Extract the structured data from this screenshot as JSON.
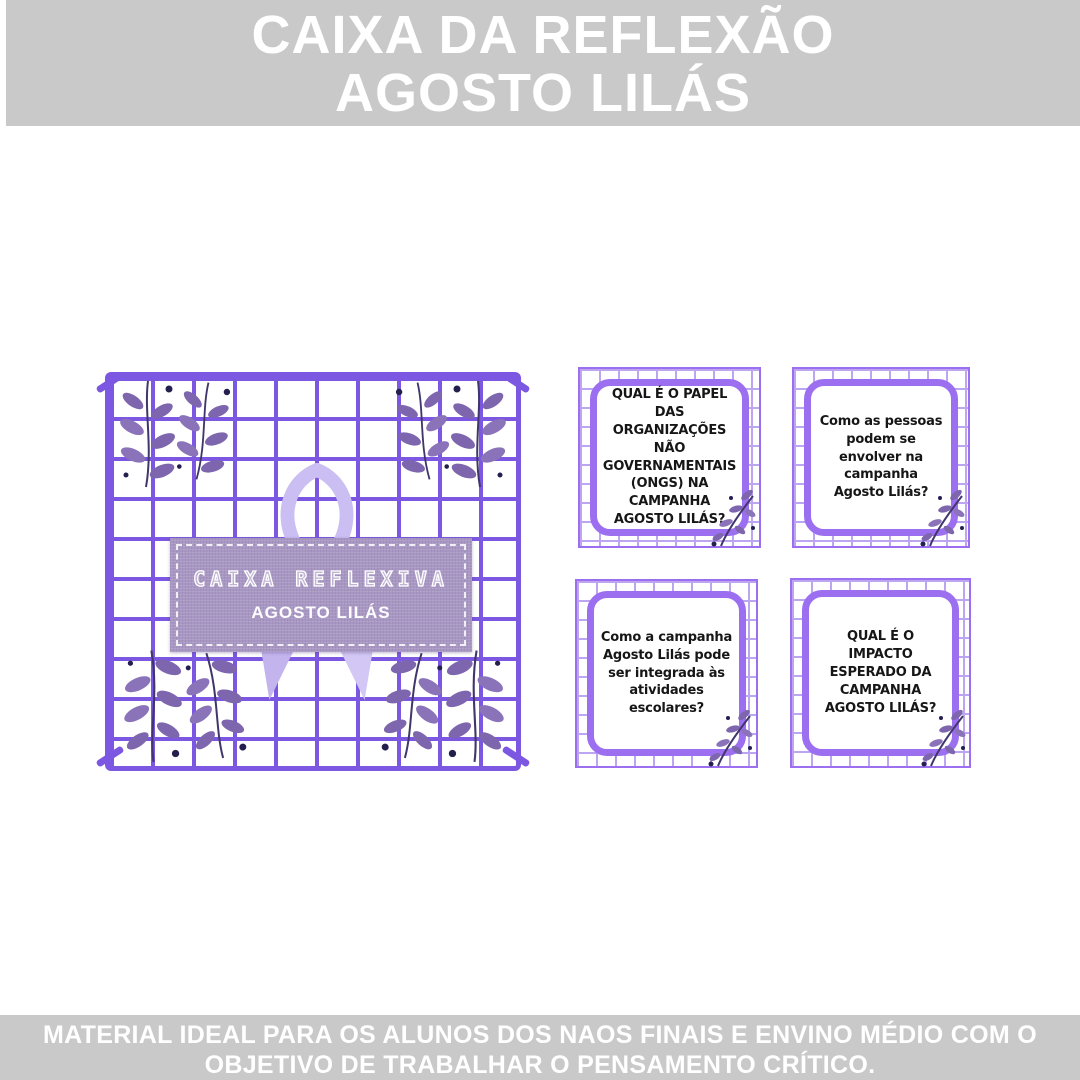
{
  "colors": {
    "banner_bg": "#c9c9c9",
    "banner_text": "#ffffff",
    "grid": "#7c58e2",
    "card_border": "#9c6ff0",
    "card_grid": "#bda6f1",
    "label_bg": "#a897c3",
    "ribbon": "#cbbef2",
    "ribbon_shade": "#c3b4ee",
    "ribbon_light": "#d2c7f5",
    "leaf": "#7d66ad",
    "leaf_light": "#8a73b8",
    "leaf_stem": "#40366b",
    "berry": "#232050"
  },
  "header": {
    "line1": "CAIXA DA REFLEXÃO",
    "line2": "AGOSTO LILÁS"
  },
  "box_label": {
    "title": "CAIXA REFLEXIVA",
    "subtitle": "AGOSTO LILÁS"
  },
  "icons": {
    "ribbon": "awareness-ribbon",
    "corner_leaves": "leaf-sprig",
    "card_leaves": "leaf-sprig-small"
  },
  "cards": [
    {
      "question": "QUAL É O PAPEL DAS ORGANIZAÇÕES NÃO GOVERNAMENTAIS (ONGS) NA CAMPANHA AGOSTO LILÁS?"
    },
    {
      "question": "Como as pessoas podem se envolver na campanha Agosto Lilás?"
    },
    {
      "question": "Como a campanha Agosto Lilás pode ser integrada às atividades escolares?"
    },
    {
      "question": "QUAL É O IMPACTO ESPERADO DA CAMPANHA AGOSTO LILÁS?"
    }
  ],
  "footer": {
    "line1": "MATERIAL IDEAL PARA OS ALUNOS DOS NAOS FINAIS E ENVINO MÉDIO COM O",
    "line2": "OBJETIVO DE TRABALHAR O PENSAMENTO CRÍTICO."
  }
}
